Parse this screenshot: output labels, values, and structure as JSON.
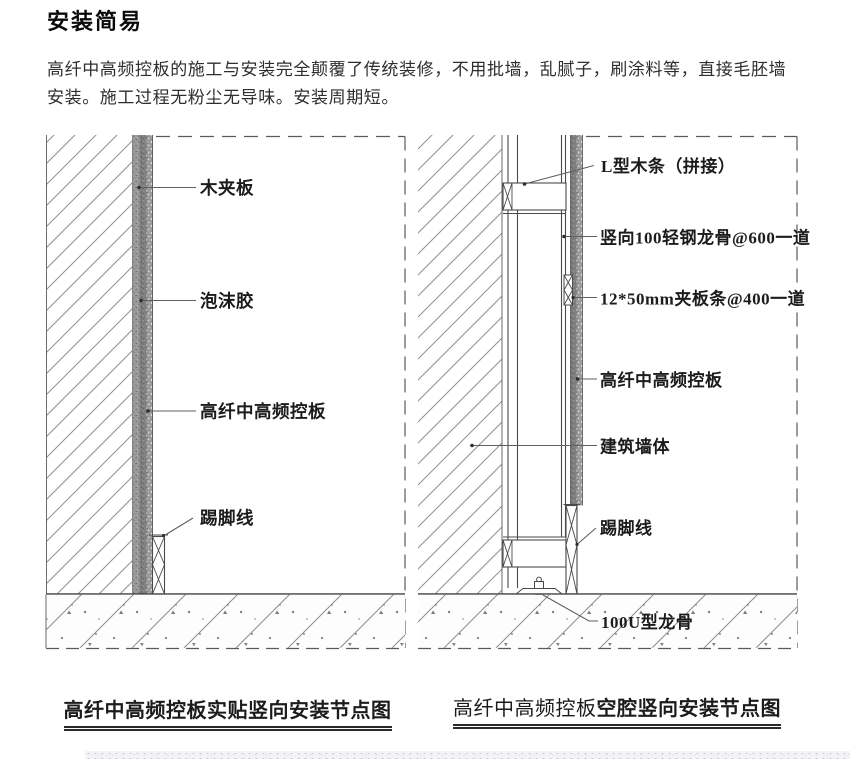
{
  "page": {
    "title": "安装简易",
    "intro_line1": "高纤中高频控板的施工与安装完全颠覆了传统装修，不用批墙，乱腻子，刷涂料等，直接毛胚墙",
    "intro_line2": "安装。施工过程无粉尘无导味。安装周期短。"
  },
  "colors": {
    "line": "#4a4a4a",
    "hatch": "#8f8f8f",
    "dash": "#5a5a5a",
    "label_text": "#1c1c1c",
    "background": "#ffffff"
  },
  "left_diagram": {
    "caption": "高纤中高频控板实贴竖向安装节点图",
    "labels": {
      "plywood": "木夹板",
      "foam_glue": "泡沫胶",
      "panel": "高纤中高频控板",
      "skirting": "踢脚线"
    }
  },
  "right_diagram": {
    "caption_prefix": "高纤中高频控板",
    "caption_suffix": "空腔竖向安装节点图",
    "labels": {
      "l_wood_strip": "L型木条（拼接）",
      "vertical_keel": "竖向100轻钢龙骨@600一道",
      "plywood_strip": "12*50mm夹板条@400一道",
      "panel": "高纤中高频控板",
      "building_wall": "建筑墙体",
      "skirting": "踢脚线",
      "u_channel_keel": "100U型龙骨"
    }
  }
}
